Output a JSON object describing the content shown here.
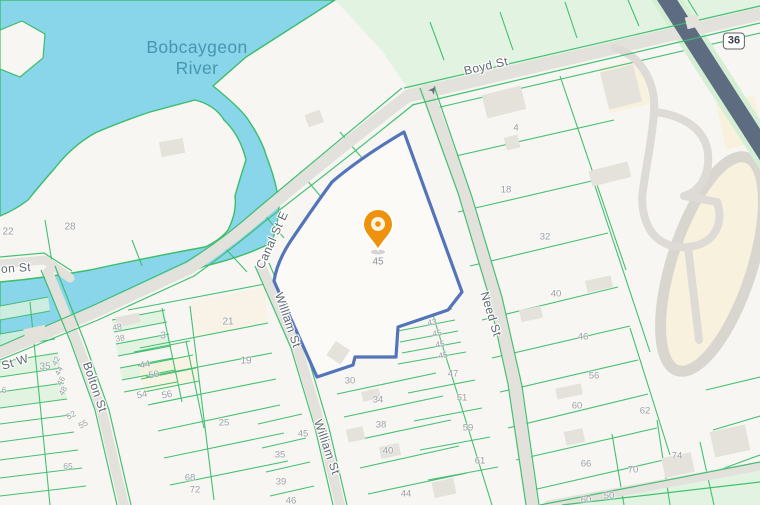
{
  "map": {
    "water_label": {
      "line1": "Bobcaygeon",
      "line2": "River"
    },
    "highway_shield": {
      "text": "36"
    },
    "marker": {
      "label": "45"
    },
    "oneway_arrow": {
      "glyph": "➤"
    },
    "streets": [
      {
        "name": "Boyd St",
        "x": 486,
        "y": 66,
        "rot": -13,
        "size": 12
      },
      {
        "name": "Canal St E",
        "x": 272,
        "y": 240,
        "rot": -66,
        "size": 12
      },
      {
        "name": "William St",
        "x": 288,
        "y": 320,
        "rot": 71,
        "size": 12
      },
      {
        "name": "William St",
        "x": 327,
        "y": 447,
        "rot": 71,
        "size": 12
      },
      {
        "name": "Need St",
        "x": 491,
        "y": 314,
        "rot": 73,
        "size": 12
      },
      {
        "name": "Bolton St",
        "x": 95,
        "y": 387,
        "rot": 71,
        "size": 12
      },
      {
        "name": "on St",
        "x": 16,
        "y": 268,
        "rot": -4,
        "size": 12
      },
      {
        "name": "St W",
        "x": 15,
        "y": 362,
        "rot": -17,
        "size": 12
      }
    ],
    "lot_numbers": [
      {
        "t": "22",
        "x": 8,
        "y": 232,
        "s": 10
      },
      {
        "t": "28",
        "x": 70,
        "y": 227,
        "s": 10
      },
      {
        "t": "4",
        "x": 516,
        "y": 128
      },
      {
        "t": "18",
        "x": 506,
        "y": 190
      },
      {
        "t": "32",
        "x": 545,
        "y": 237
      },
      {
        "t": "40",
        "x": 556,
        "y": 294
      },
      {
        "t": "46",
        "x": 583,
        "y": 337
      },
      {
        "t": "56",
        "x": 594,
        "y": 376
      },
      {
        "t": "60",
        "x": 577,
        "y": 406
      },
      {
        "t": "62",
        "x": 645,
        "y": 411
      },
      {
        "t": "66",
        "x": 586,
        "y": 464
      },
      {
        "t": "70",
        "x": 633,
        "y": 470
      },
      {
        "t": "74",
        "x": 677,
        "y": 456
      },
      {
        "t": "60",
        "x": 586,
        "y": 500
      },
      {
        "t": "50",
        "x": 609,
        "y": 496
      },
      {
        "t": "21",
        "x": 228,
        "y": 322,
        "s": 10
      },
      {
        "t": "19",
        "x": 246,
        "y": 361,
        "s": 10
      },
      {
        "t": "3",
        "x": 163,
        "y": 336,
        "s": 10
      },
      {
        "t": "35",
        "x": 45,
        "y": 367,
        "s": 10
      },
      {
        "t": "44",
        "x": 145,
        "y": 365,
        "r": -12
      },
      {
        "t": "50",
        "x": 154,
        "y": 375,
        "r": -12
      },
      {
        "t": "54",
        "x": 142,
        "y": 395,
        "r": -12
      },
      {
        "t": "56",
        "x": 167,
        "y": 395,
        "r": -12
      },
      {
        "t": "25",
        "x": 224,
        "y": 423
      },
      {
        "t": "30",
        "x": 350,
        "y": 381
      },
      {
        "t": "34",
        "x": 378,
        "y": 400
      },
      {
        "t": "38",
        "x": 381,
        "y": 425
      },
      {
        "t": "40",
        "x": 388,
        "y": 451
      },
      {
        "t": "44",
        "x": 406,
        "y": 494
      },
      {
        "t": "47",
        "x": 453,
        "y": 374
      },
      {
        "t": "51",
        "x": 462,
        "y": 398
      },
      {
        "t": "59",
        "x": 468,
        "y": 428
      },
      {
        "t": "61",
        "x": 480,
        "y": 461
      },
      {
        "t": "43",
        "x": 432,
        "y": 322,
        "s": 8.5,
        "r": -10
      },
      {
        "t": "45",
        "x": 437,
        "y": 333,
        "s": 8.5,
        "r": -10
      },
      {
        "t": "45",
        "x": 440,
        "y": 344,
        "s": 8.5,
        "r": -10
      },
      {
        "t": "45",
        "x": 443,
        "y": 355,
        "s": 8.5,
        "r": -10
      },
      {
        "t": "45",
        "x": 303,
        "y": 434
      },
      {
        "t": "35",
        "x": 280,
        "y": 455
      },
      {
        "t": "39",
        "x": 281,
        "y": 482
      },
      {
        "t": "46",
        "x": 291,
        "y": 501
      },
      {
        "t": "42",
        "x": 56,
        "y": 361,
        "s": 8,
        "r": -62
      },
      {
        "t": "44",
        "x": 59,
        "y": 371,
        "s": 8,
        "r": -62
      },
      {
        "t": "46",
        "x": 61,
        "y": 381,
        "s": 8,
        "r": -62
      },
      {
        "t": "48",
        "x": 63,
        "y": 391,
        "s": 8,
        "r": -62
      },
      {
        "t": "52",
        "x": 71,
        "y": 415,
        "s": 8.5,
        "r": -28
      },
      {
        "t": "55",
        "x": 83,
        "y": 424,
        "s": 8.5,
        "r": -28
      },
      {
        "t": "65",
        "x": 68,
        "y": 466,
        "s": 8.5
      },
      {
        "t": "48",
        "x": 117,
        "y": 327,
        "s": 8.5,
        "r": -10
      },
      {
        "t": "38",
        "x": 120,
        "y": 338,
        "s": 8.5,
        "r": -10
      },
      {
        "t": "68",
        "x": 190,
        "y": 478
      },
      {
        "t": "72",
        "x": 195,
        "y": 490
      },
      {
        "t": "6",
        "x": 4,
        "y": 390,
        "s": 8.5
      }
    ],
    "colors": {
      "water": "#89d5e9",
      "land": "#f7f6f2",
      "road": "#e3e1dc",
      "highway": "#5d6c80",
      "parcel": "#3bbd6b",
      "tint": "#ddf3dd",
      "cream": "#f8f1de",
      "boundary": "#5474ba",
      "building": "#e5e2dc",
      "marker": "#ee920e",
      "streetText": "#5f6870",
      "lotText": "#9aa0a6",
      "waterText": "#4796b1"
    }
  }
}
